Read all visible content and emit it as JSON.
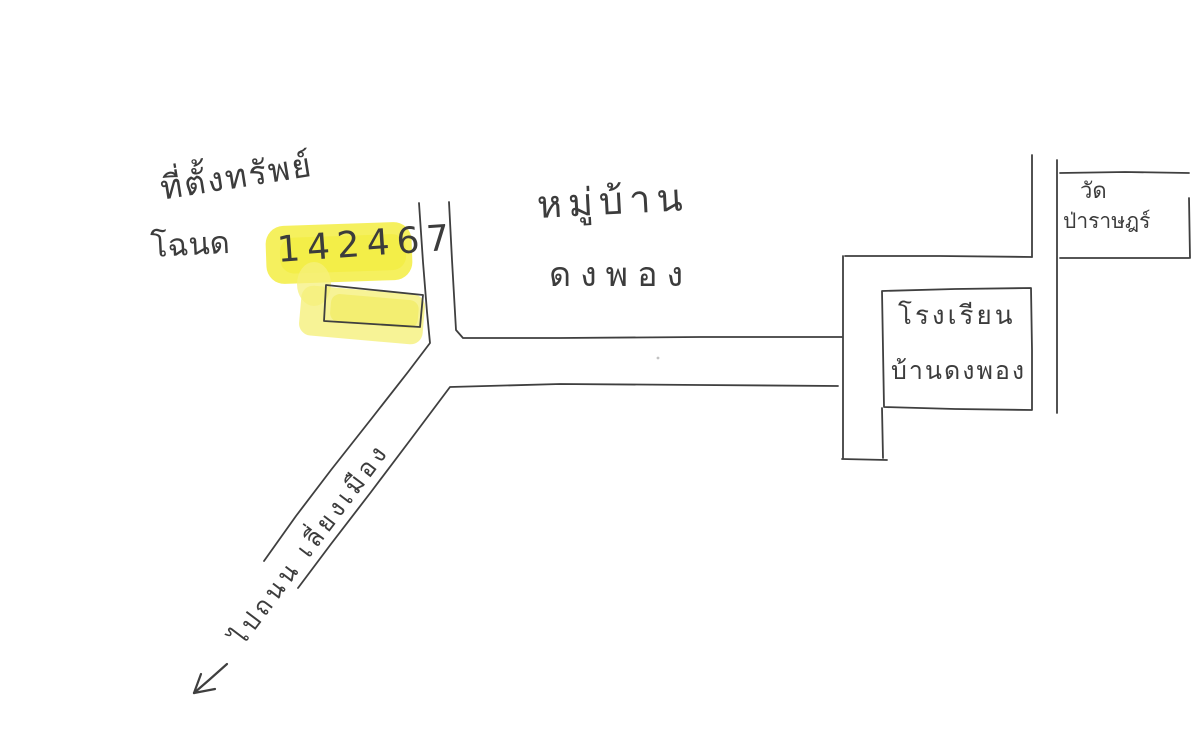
{
  "page": {
    "background_color": "#ffffff",
    "ink_color": "#3f3f3f",
    "highlight_color": "#f4ee48"
  },
  "property": {
    "location_label": "ที่ตั้งทรัพย์",
    "deed_label": "โฉนด",
    "deed_number": "142467"
  },
  "village": {
    "line1": "หมู่บ้าน",
    "line2": "ดงพอง"
  },
  "school": {
    "line1": "โรงเรียน",
    "line2": "บ้านดงพอง"
  },
  "temple": {
    "line1": "วัด",
    "line2": "ป่าราษฎร์"
  },
  "road": {
    "direction_label": "ไปถนน เลี่ยงเมือง"
  }
}
